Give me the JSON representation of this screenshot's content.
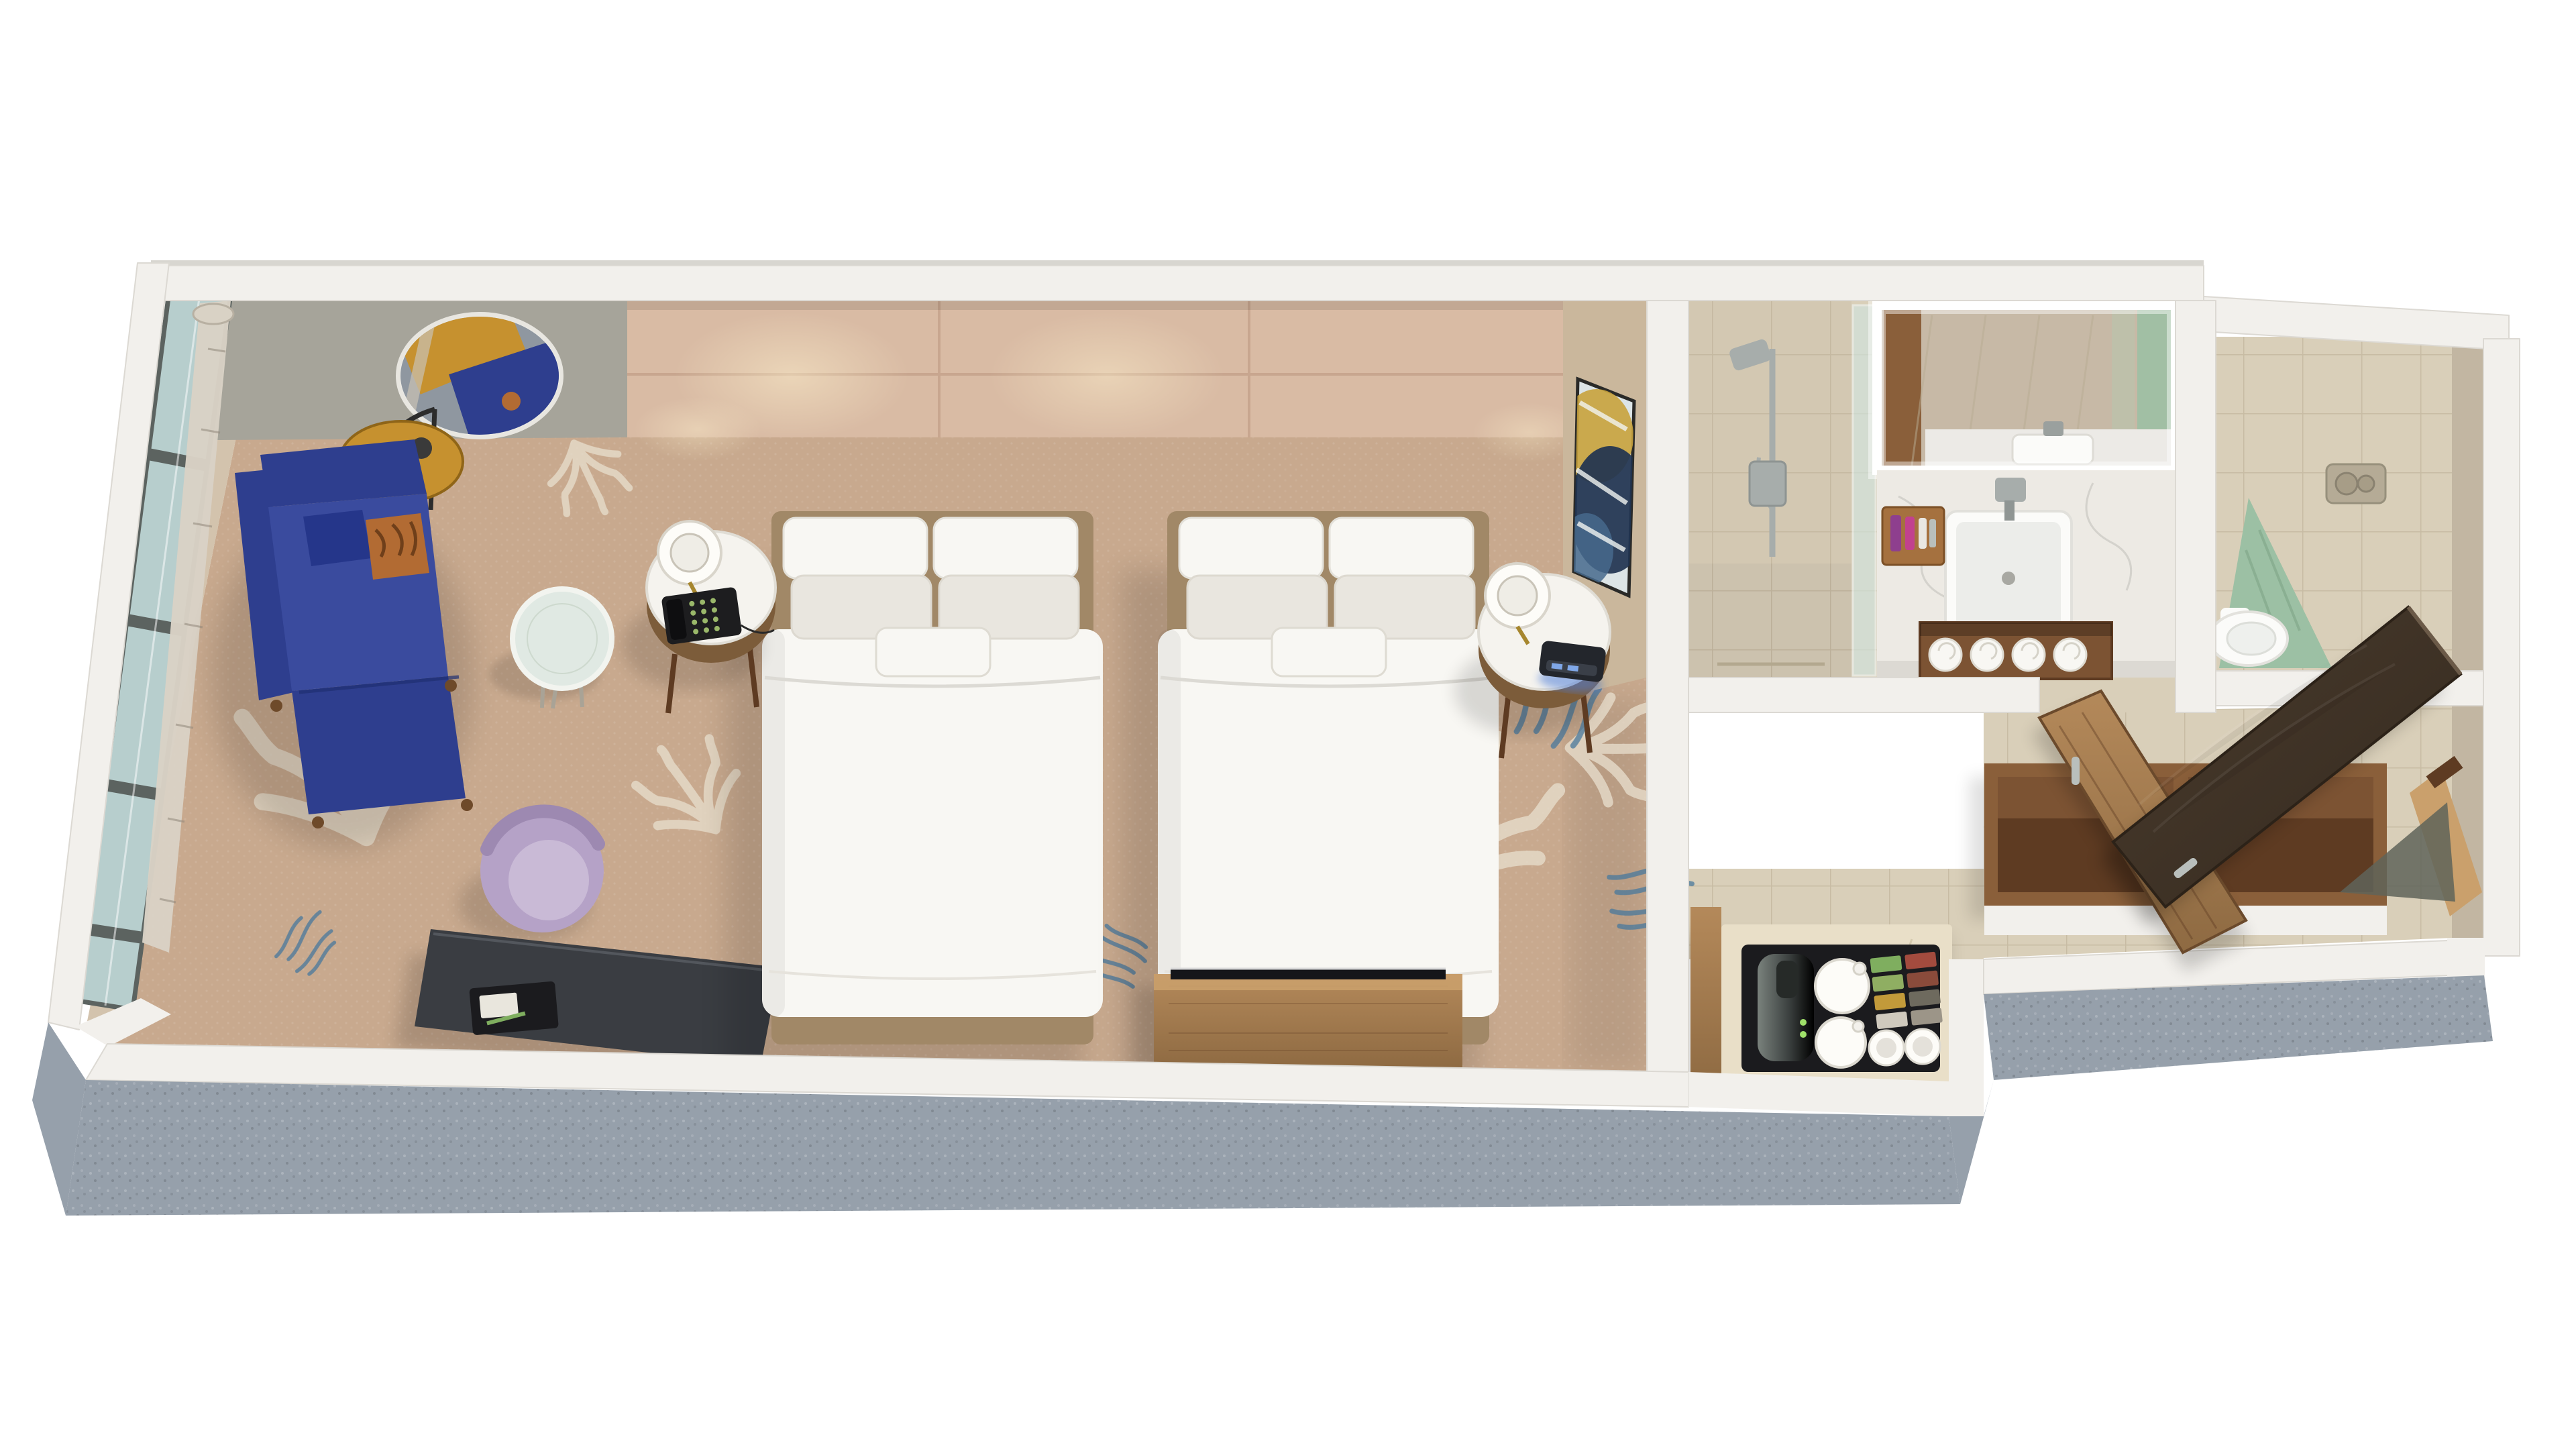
{
  "scene": {
    "title": "Hotel guest room – 3D cutaway floor plan render",
    "view": "isometric top-down cutaway",
    "background": "#ffffff"
  },
  "colors": {
    "wall_top": "#f2f0ec",
    "wall_edge": "#dcd9d3",
    "wall_outer_gray": "#96a0ab",
    "accent_wall": "#a6a49a",
    "headboard_wall": "#d9bba4",
    "headboard_seam": "#c3a18a",
    "art_wall": "#cab79c",
    "east_wall_face": "#c2b6a2",
    "window_glass": "#b7cecd",
    "window_mullion": "#5c6360",
    "curtain": "#d9d2c5",
    "carpet": "#c8a98e",
    "carpet_border": "#d3c3ad",
    "carpet_motif_white": "#e7dccb",
    "carpet_motif_blue": "#49799c",
    "sofa_blue": "#2e3e8e",
    "sofa_blue_light": "#3a4b9e",
    "sofa_pillow_blue": "#25368a",
    "accent_pillow_orange": "#b26b33",
    "lamp_gold": "#c6912f",
    "metal_dark": "#2c2c2c",
    "table_glass": "#e0e9e3",
    "chair_purple": "#b5a2c7",
    "chair_purple_light": "#c9bad6",
    "desk_dark": "#3a3d42",
    "tray_black": "#1b1b1e",
    "bed_linen": "#f8f7f3",
    "bed_linen_shade": "#e9e6df",
    "bed_base": "#a18867",
    "nightstand_wood": "#7c5c3a",
    "nightstand_top": "#f5f3ee",
    "lamp_shade": "#fdfcf8",
    "phone_black": "#1d1d1f",
    "clock_body": "#23262c",
    "clock_glow": "#4f7fd9",
    "wood": "#8a5f3a",
    "wood_dark": "#5e3b22",
    "wood_light": "#b4895a",
    "tile": "#d9cfb9",
    "tile_grout": "#b9ad94",
    "marble": "#edeae4",
    "marble_vein": "#c9c7c2",
    "mirror_base": "#c7b9a6",
    "chrome": "#a7adab",
    "shower_glass": "#cfe3de",
    "towel_green": "#9cc0a4",
    "flush_plate": "#b5ab96",
    "porcelain": "#fbfbf9",
    "entry_door": "#42352a",
    "handle_silver": "#b9bfbc",
    "kettle_dark": "#4a504d",
    "led_green": "#9fe06a",
    "entry_mat": "#5f6459",
    "artwork_ice": "#dce4e6",
    "artwork_navy": "#1f3350",
    "artwork_gold": "#c8a23c",
    "packets": [
      "#7fae5f",
      "#a34b3e",
      "#8fae62",
      "#8a4b3b",
      "#c29a3a",
      "#6e6a5e",
      "#cfc9bd",
      "#9c9588"
    ]
  },
  "rooms": {
    "bedroom": {
      "label": "Guest bedroom",
      "items": [
        "queen bed 1",
        "queen bed 2",
        "nightstand with lamp and telephone",
        "nightstand with lamp and alarm clock",
        "blue chaise lounge with accent pillow",
        "round side table",
        "purple tub chair",
        "work desk with welcome tray",
        "gold floor lamp",
        "round wall mirror",
        "media console with TV",
        "coral pattern carpet",
        "floor-to-ceiling window with sheer curtain",
        "abstract wall art"
      ]
    },
    "bathroom": {
      "label": "Bathroom",
      "items": [
        "walk-in shower with slide rail",
        "glass partition",
        "marble vanity counter",
        "vessel sink",
        "lit vanity mirror",
        "amenity tray with toiletries",
        "rolled towels shelf",
        "bathroom door"
      ]
    },
    "toilet_room": {
      "label": "Water closet",
      "items": [
        "wall-hung toilet",
        "dual flush plate",
        "green towel"
      ]
    },
    "entry": {
      "label": "Entry corridor",
      "items": [
        "entry door",
        "tile floor",
        "door frame",
        "entry mat"
      ]
    },
    "closet": {
      "label": "Open closet",
      "items": [
        "wardrobe cubby 1",
        "wardrobe cubby 2"
      ]
    },
    "coffee_station": {
      "label": "Coffee and tea station",
      "items": [
        "black serving tray",
        "kettle",
        "teapots",
        "cups",
        "tea and coffee packets"
      ]
    }
  }
}
